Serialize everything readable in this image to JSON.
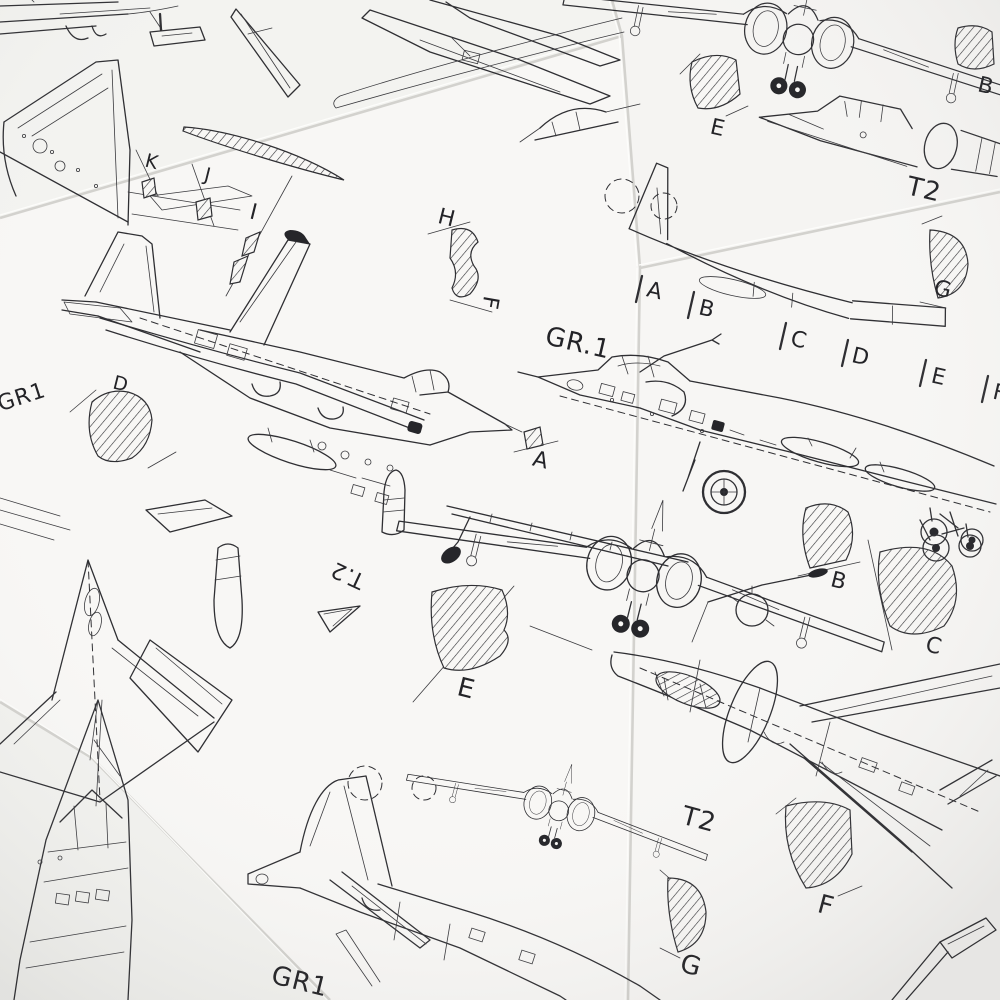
{
  "palette": {
    "ink": "#2f2f33",
    "paper": "#f8f7f5",
    "background": "#e9e8e5"
  },
  "labels": {
    "k": "K",
    "j": "J",
    "i": "I",
    "h": "H",
    "f_side": "F",
    "e_top": "E",
    "b_top": "B",
    "t2_top": "T2",
    "g_top": "G",
    "gr1_left": "GR1",
    "d": "D",
    "gr1_right": "GR.1",
    "a_section": "A",
    "row": [
      "A",
      "B",
      "C",
      "D",
      "E",
      "F"
    ],
    "e_mid": "E",
    "t2_rot": "T.2",
    "b_mid": "B",
    "c_mid": "C",
    "t2_bottom": "T2",
    "f_bottom": "F",
    "g_bottom": "G",
    "gr1_bottom": "GR1"
  }
}
